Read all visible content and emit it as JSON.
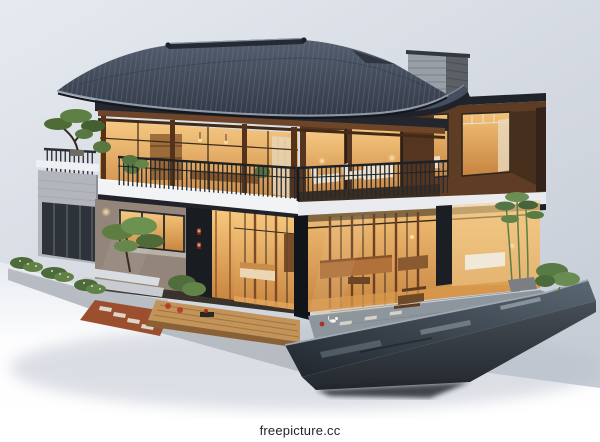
{
  "watermark": {
    "text": "freepicture.cc"
  },
  "scene": {
    "description": "3D architectural model render of a modern two-storey Chinese-style villa: dark curved-tile hip roof with upturned eaves, brick chimney, wood-framed glass walls glowing warm amber, rooftop balcony with black railing, bonsai and lounge chairs, white floor slab, concrete side volume, timber deck with steps and terracotta patio, stone terrace with tea table, bamboo and shrubs, and a dark reflective infinity pool on a floating grey diorama base against a pale blue-grey studio backdrop.",
    "elements": [
      "tiled hip-gable roof with upturned eaves",
      "grey brick chimney",
      "upper glass pavilion with timber posts",
      "flat-roofed right wing with lit bedroom windows",
      "rooftop balcony with black metal railing",
      "bonsai tree and planters",
      "white lounge chairs",
      "white intermediate floor slab",
      "grey concrete side volume",
      "glass-walled living room with warm lighting",
      "entry pillar with red wall sconces",
      "timber deck, steps and terracotta patio",
      "stone terrace with wooden tea table",
      "bamboo and green shrubs",
      "dark reflective infinity pool",
      "floating diorama base",
      "white cat on terrace"
    ]
  },
  "palette": {
    "bg-top": "#e6eaf0",
    "bg-bottom": "#c6ccd6",
    "ground-white": "#fdfdfe",
    "roof-light": "#545e6f",
    "roof-dark": "#333a47",
    "wood": "#6e4528",
    "wood-dark": "#4a2d18",
    "glow-top": "#f6c983",
    "glow-deep": "#cb8842",
    "slab": "#f2f3f5",
    "concrete": "#b2b6bc",
    "pool-light": "#5b6873",
    "pool-dark": "#20262e",
    "plant": "#56743f",
    "watermark-bg": "#ffffff",
    "watermark-text": "#1f2124"
  }
}
